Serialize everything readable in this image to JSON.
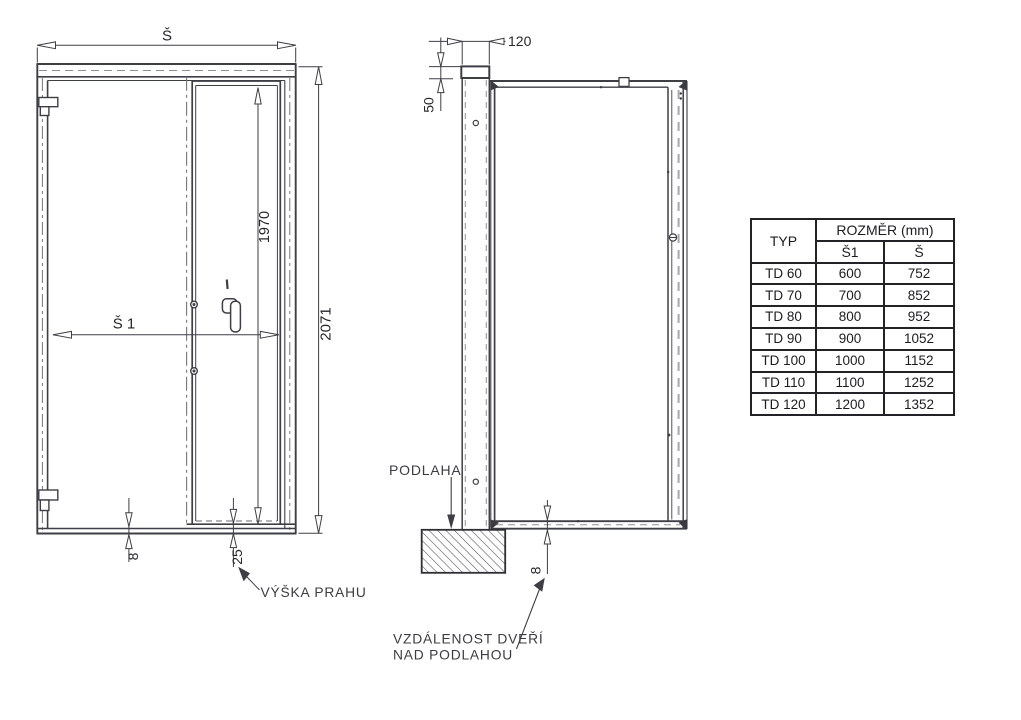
{
  "front_view": {
    "width_label": "Š",
    "clear_width_label": "Š 1",
    "leaf_height": "1970",
    "total_height": "2071",
    "bottom_gap": "8",
    "threshold_height": "25",
    "threshold_note": "VÝŠKA PRAHU"
  },
  "side_view": {
    "frame_depth": "120",
    "top_offset": "50",
    "floor_label": "PODLAHA",
    "floor_gap": "8",
    "floor_gap_note_line1": "VZDÁLENOST DVEŘÍ",
    "floor_gap_note_line2": "NAD PODLAHOU"
  },
  "size_table": {
    "type_header": "TYP",
    "dimension_header": "ROZMĚR (mm)",
    "col_s1_header": "Š1",
    "col_s_header": "Š",
    "rows": [
      {
        "typ": "TD 60",
        "s1": "600",
        "s": "752"
      },
      {
        "typ": "TD 70",
        "s1": "700",
        "s": "852"
      },
      {
        "typ": "TD 80",
        "s1": "800",
        "s": "952"
      },
      {
        "typ": "TD 90",
        "s1": "900",
        "s": "1052"
      },
      {
        "typ": "TD 100",
        "s1": "1000",
        "s": "1152"
      },
      {
        "typ": "TD 110",
        "s1": "1100",
        "s": "1252"
      },
      {
        "typ": "TD 120",
        "s1": "1200",
        "s": "1352"
      }
    ]
  },
  "colors": {
    "line": "#3e3e46",
    "text": "#26262b",
    "table_border": "#232327",
    "background": "#ffffff"
  }
}
